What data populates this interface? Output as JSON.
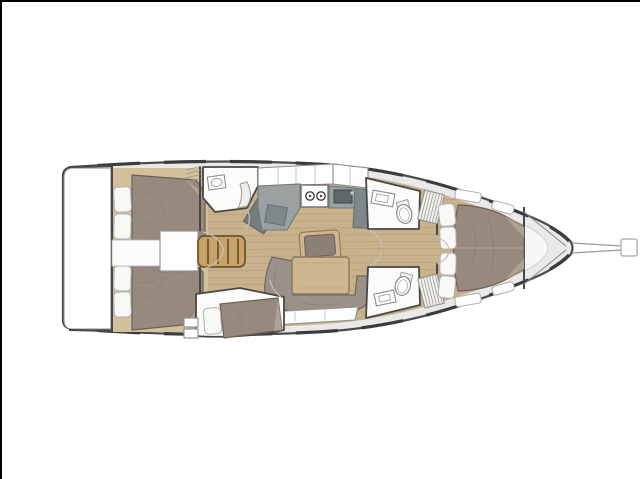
{
  "page": {
    "background": "#ffffff",
    "border": "#000000"
  },
  "palette": {
    "page_background": "#ffffff",
    "page_border": "#000000",
    "hull_outline": "#4a4a4a",
    "deck": "#eae9e7",
    "cabin_floor_ivory": "#f8f7f5",
    "wood_floor": "#c9b28b",
    "wood_plank_line": "#ae9770",
    "cabin_wood_trim": "#d2c09a",
    "bed_fabric": "#97897d",
    "bed_fabric_dark": "#6c6156",
    "bed_fold_highlight": "#b3a698",
    "pillow": "#f8f8f7",
    "pillow_border": "#b0b0b0",
    "settee": "#9a9188",
    "counter_gray": "#9ba1a1",
    "counter_dark": "#7e8889",
    "locker_dark_gray": "#747c7e",
    "fixture_white": "#fbfbfa",
    "wall": "#474747",
    "wood_ladder": "#c8a368",
    "wood_ladder_dark": "#6d5432",
    "table_wood": "#cdb690",
    "table_border": "#8a795a",
    "door_arc": "#c4c0b8",
    "rail_dash": "#3c3c3c",
    "bowsprit_line": "#9a9a9a",
    "sink_dark": "#5e686a"
  },
  "diagram": {
    "type": "yacht-interior-floor-plan",
    "orientation": "bow-right-stern-left",
    "rooms": [
      "transom-swim-platform",
      "aft-cabin-port",
      "aft-cabin-starboard",
      "aft-heads",
      "companionway",
      "galley",
      "salon",
      "mid-cabin-starboard",
      "forward-heads-port",
      "forward-heads-starboard",
      "forward-cabin",
      "anchor-locker"
    ],
    "fixtures": [
      "double-bed",
      "pillow",
      "companionway-ladder",
      "stove-two-burners",
      "galley-sink",
      "washbasin",
      "toilet",
      "salon-table",
      "salon-chair",
      "settee",
      "navigation-locker",
      "slatted-wardrobe",
      "deck-hatch",
      "bowsprit"
    ]
  }
}
